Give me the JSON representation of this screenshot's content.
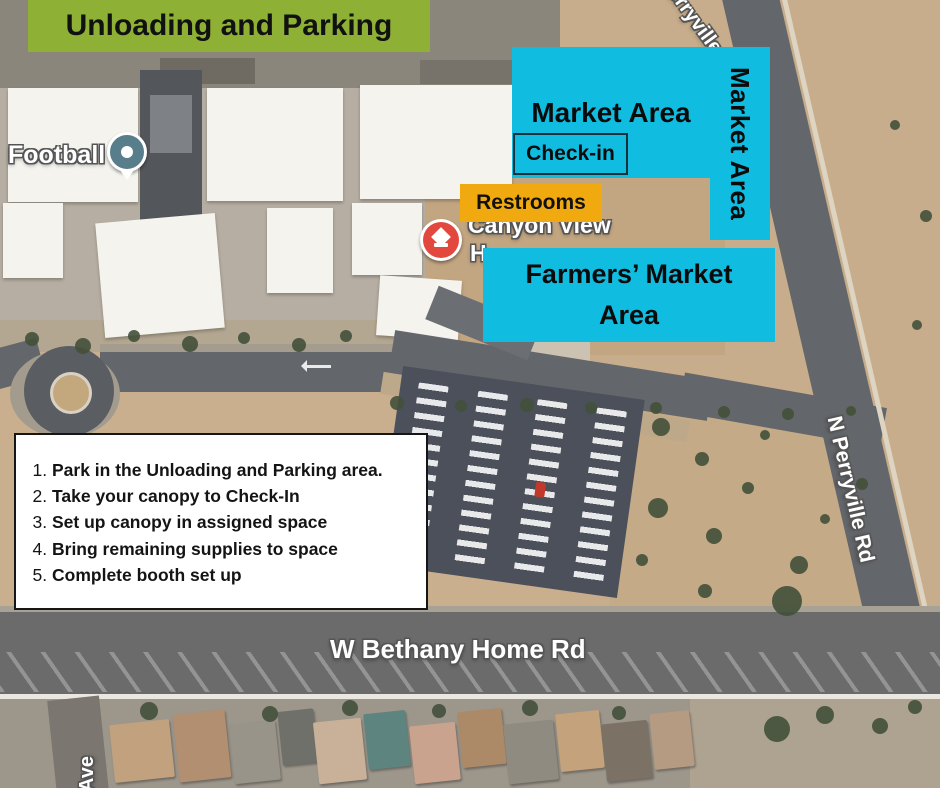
{
  "banner": {
    "label": "Unloading and Parking"
  },
  "areas": {
    "market_horizontal": "Market Area",
    "market_vertical": "Market Area",
    "check_in": "Check-in",
    "restrooms": "Restrooms",
    "farmers_line1": "Farmers’ Market",
    "farmers_line2": "Area"
  },
  "instructions": {
    "items": [
      "Park in the Unloading and Parking area.",
      "Take your canopy to Check-In",
      "Set up canopy in assigned space",
      "Bring remaining supplies to space",
      "Complete booth set up"
    ]
  },
  "map_labels": {
    "football": "Football",
    "school_name_line1": "Canyon View",
    "school_name_line2": "H",
    "road_n_perryville_top": "N Perryville Rd",
    "road_n_perryville": "N Perryville Rd",
    "road_w_bethany": "W Bethany Home Rd",
    "road_ave": "Ave"
  },
  "icons": {
    "football_pin": "map-pin",
    "school_marker": "graduation-cap-marker",
    "road_arrow": "left-arrow"
  },
  "colors": {
    "banner_green": "#8db035",
    "area_cyan": "#10bde0",
    "restrooms_orange": "#f0a90e",
    "instructions_bg": "#ffffff",
    "desert_tan": "#c9af8e"
  }
}
